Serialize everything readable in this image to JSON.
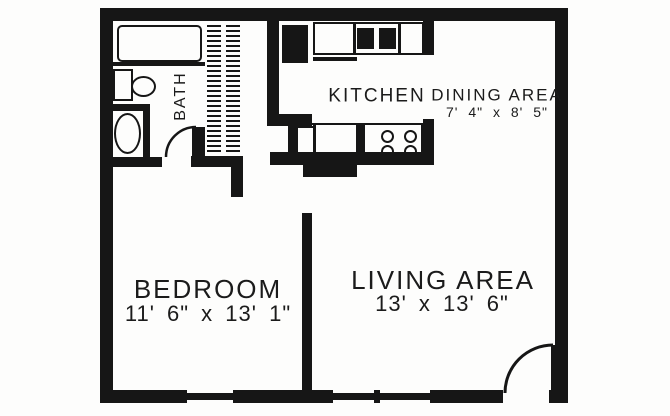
{
  "plan_type": "apartment-floor-plan",
  "rooms": {
    "bath": {
      "label": "BATH"
    },
    "kitchen": {
      "label": "KITCHEN"
    },
    "dining": {
      "label": "DINING AREA",
      "dimensions": "7' 4\" x 8' 5\""
    },
    "bedroom": {
      "label": "BEDROOM",
      "dimensions": "11' 6\" x 13' 1\""
    },
    "living": {
      "label": "LIVING AREA",
      "dimensions": "13' x 13' 6\""
    }
  },
  "fixtures": {
    "bathtub": "rounded-rect-outline",
    "vanity-sink": "rect-plus-oval",
    "toilet": "oval-in-alcove",
    "closet": "double-hatched-strips",
    "refrigerator": "solid-rect",
    "kitchen-sink": "two-solid-squares-in-counter",
    "range": "four-burner-circles",
    "dishwasher": "small-rect-outline",
    "bath-door": "quarter-arc",
    "entry-door": "quarter-arc-with-leaf",
    "windows": "thin-wall-segments"
  },
  "colors": {
    "line": "#161616",
    "paper": "#fdfdfc"
  }
}
